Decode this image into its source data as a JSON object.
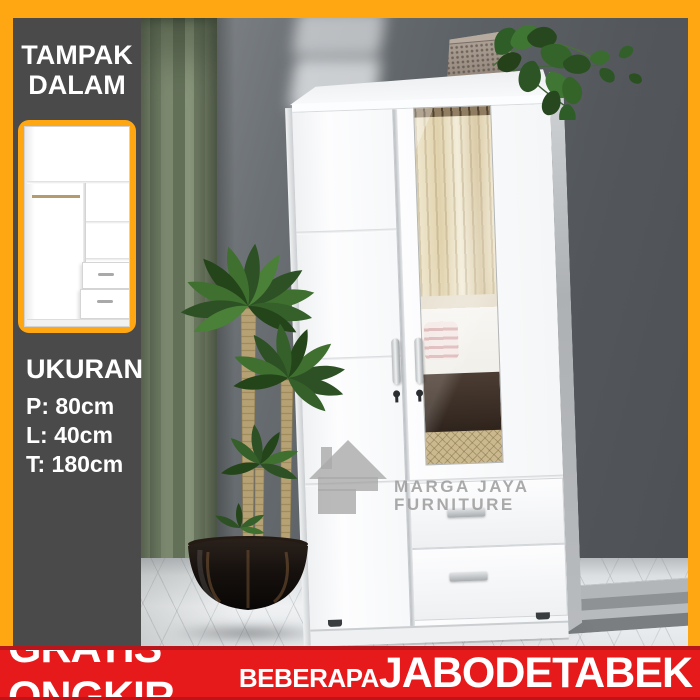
{
  "panel": {
    "heading": {
      "line1": "TAMPAK",
      "line2": "DALAM"
    },
    "dimensions": {
      "title": "UKURAN",
      "items": [
        "P: 80cm",
        "L: 40cm",
        "T: 180cm"
      ]
    }
  },
  "watermark": {
    "line1": "MARGA JAYA",
    "line2": "FURNITURE"
  },
  "banner": {
    "main": "GRATIS ONGKIR",
    "qualifier": "BEBERAPA",
    "region": "JABODETABEK"
  },
  "colors": {
    "frame_orange": "#FFA613",
    "panel_gray": "#4A4A4A",
    "banner_red": "#E6191B",
    "banner_red_dark": "#B9151A",
    "text_white": "#FFFFFF",
    "watermark_gray": "#9B9B9B",
    "curtain_green": "#7D8A71"
  }
}
